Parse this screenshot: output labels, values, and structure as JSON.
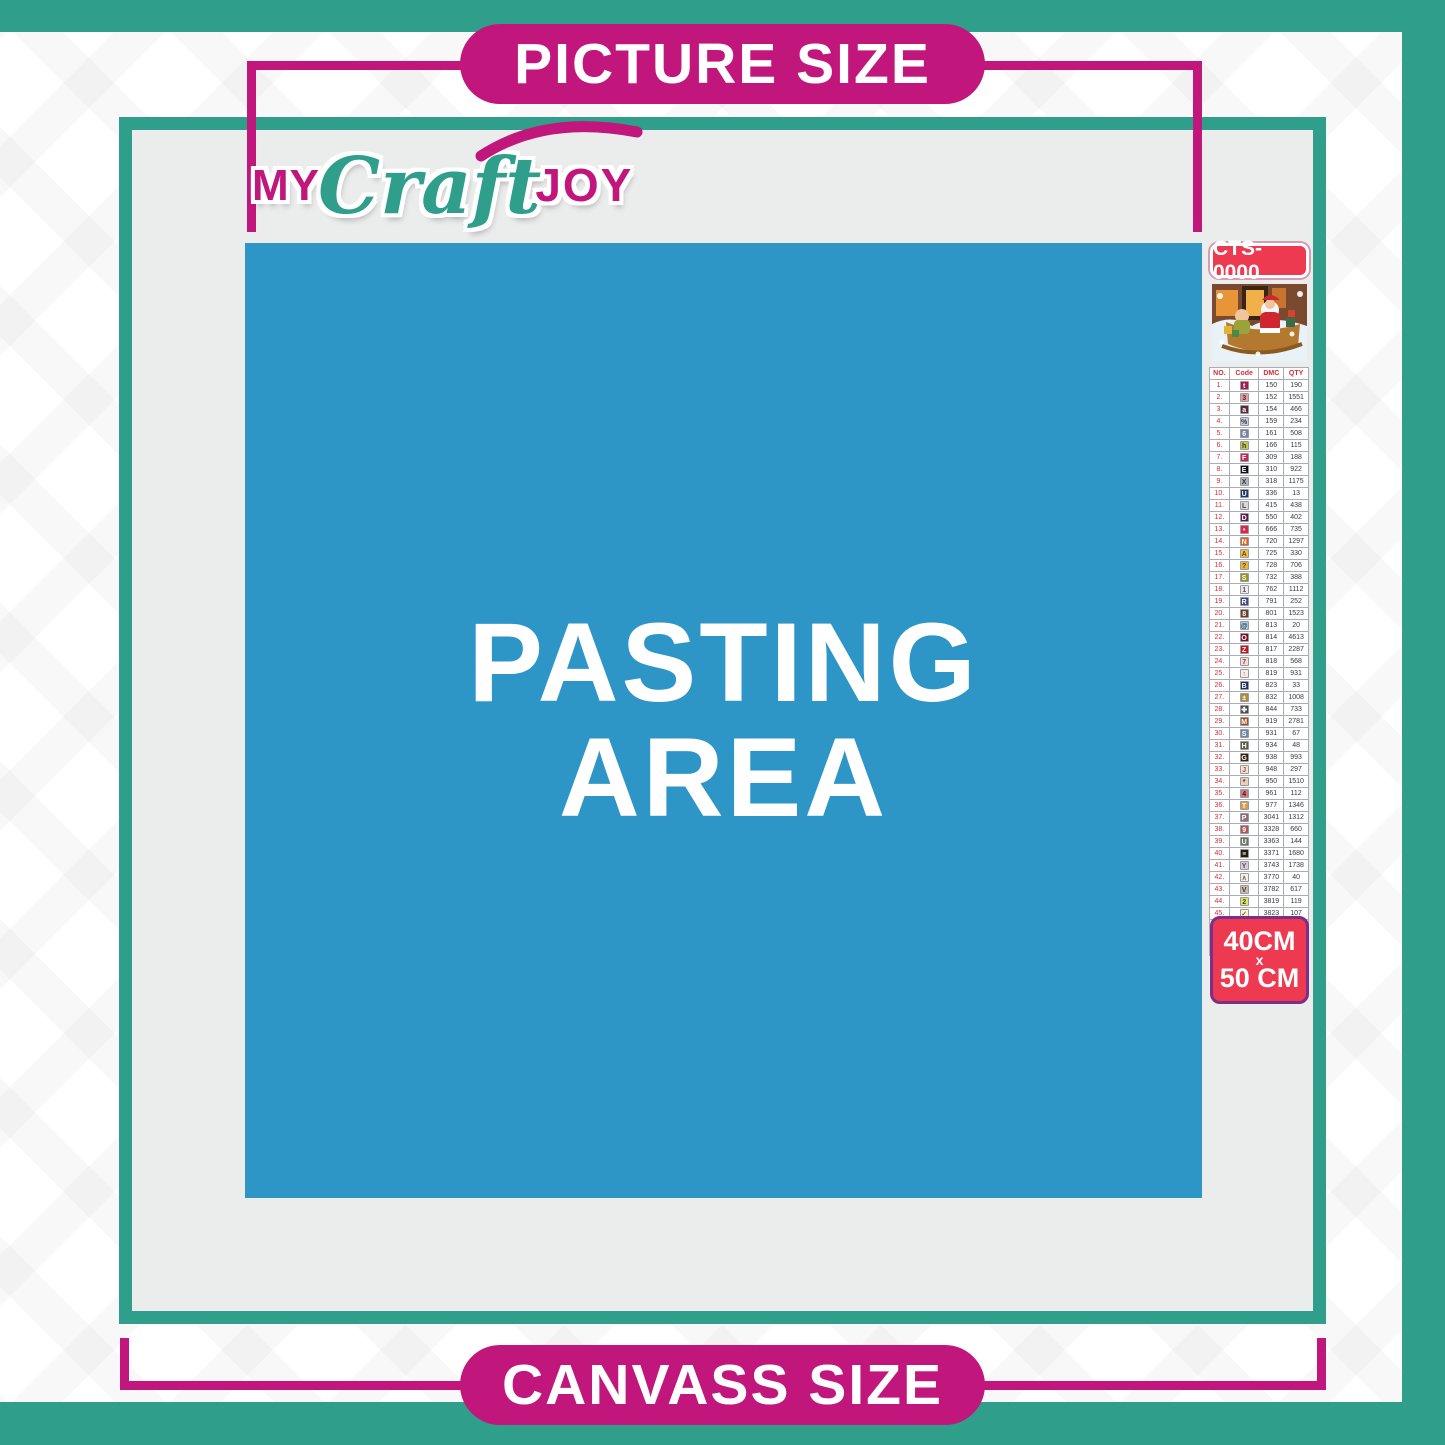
{
  "labels": {
    "picture_size": "PICTURE SIZE",
    "canvass_size": "CANVASS SIZE"
  },
  "logo": {
    "part1": "MY",
    "part2": "Craft",
    "part3": "JOY"
  },
  "pasting_area": {
    "line1": "PASTING",
    "line2": "AREA"
  },
  "legend": {
    "kit_code": "CTS-0000",
    "preview_image": "christmas-santa-sleigh-scene",
    "size": {
      "line1": "40CM",
      "line2": "x",
      "line3": "50 CM"
    },
    "table": {
      "headers": [
        "NO.",
        "Code",
        "DMC",
        "QTY"
      ],
      "rows": [
        {
          "no": "1.",
          "sym": "t",
          "bg": "#a51c4f",
          "fg": "#ffffff",
          "dmc": "150",
          "qty": "190"
        },
        {
          "no": "2.",
          "sym": "3",
          "bg": "#dfa49e",
          "fg": "#5a2430",
          "dmc": "152",
          "qty": "1551"
        },
        {
          "no": "3.",
          "sym": "a",
          "bg": "#5a2a3c",
          "fg": "#ffffff",
          "dmc": "154",
          "qty": "466"
        },
        {
          "no": "4.",
          "sym": "%",
          "bg": "#c9cbd8",
          "fg": "#3a3a52",
          "dmc": "159",
          "qty": "234"
        },
        {
          "no": "5.",
          "sym": "6",
          "bg": "#7a82a6",
          "fg": "#ffffff",
          "dmc": "161",
          "qty": "508"
        },
        {
          "no": "6.",
          "sym": "h",
          "bg": "#c3c553",
          "fg": "#3c3c14",
          "dmc": "166",
          "qty": "115"
        },
        {
          "no": "7.",
          "sym": "F",
          "bg": "#c22a55",
          "fg": "#ffffff",
          "dmc": "309",
          "qty": "188"
        },
        {
          "no": "8.",
          "sym": "E",
          "bg": "#111111",
          "fg": "#ffffff",
          "dmc": "310",
          "qty": "922"
        },
        {
          "no": "9.",
          "sym": "X",
          "bg": "#b0b5bd",
          "fg": "#33333a",
          "dmc": "318",
          "qty": "1175"
        },
        {
          "no": "10.",
          "sym": "U",
          "bg": "#223a6b",
          "fg": "#ffffff",
          "dmc": "336",
          "qty": "13"
        },
        {
          "no": "11.",
          "sym": "L",
          "bg": "#d6d8dc",
          "fg": "#44444a",
          "dmc": "415",
          "qty": "438"
        },
        {
          "no": "12.",
          "sym": "D",
          "bg": "#5e1b51",
          "fg": "#ffffff",
          "dmc": "550",
          "qty": "402"
        },
        {
          "no": "13.",
          "sym": "•",
          "bg": "#e32544",
          "fg": "#ffffff",
          "dmc": "666",
          "qty": "735"
        },
        {
          "no": "14.",
          "sym": "N",
          "bg": "#e2641f",
          "fg": "#ffffff",
          "dmc": "720",
          "qty": "1297"
        },
        {
          "no": "15.",
          "sym": "A",
          "bg": "#f2bf4e",
          "fg": "#6b4a00",
          "dmc": "725",
          "qty": "330"
        },
        {
          "no": "16.",
          "sym": "?",
          "bg": "#e7b53e",
          "fg": "#5d4300",
          "dmc": "728",
          "qty": "706"
        },
        {
          "no": "17.",
          "sym": "S",
          "bg": "#989421",
          "fg": "#ffffff",
          "dmc": "732",
          "qty": "388"
        },
        {
          "no": "18.",
          "sym": "1",
          "bg": "#efe9e9",
          "fg": "#55555a",
          "dmc": "762",
          "qty": "1112"
        },
        {
          "no": "19.",
          "sym": "R",
          "bg": "#3c4b85",
          "fg": "#ffffff",
          "dmc": "791",
          "qty": "252"
        },
        {
          "no": "20.",
          "sym": "8",
          "bg": "#6e4022",
          "fg": "#ffffff",
          "dmc": "801",
          "qty": "1523"
        },
        {
          "no": "21.",
          "sym": "@",
          "bg": "#a9c8de",
          "fg": "#2c4a63",
          "dmc": "813",
          "qty": "20"
        },
        {
          "no": "22.",
          "sym": "O",
          "bg": "#7d1022",
          "fg": "#ffffff",
          "dmc": "814",
          "qty": "4613"
        },
        {
          "no": "23.",
          "sym": "Z",
          "bg": "#c4171d",
          "fg": "#ffffff",
          "dmc": "817",
          "qty": "2287"
        },
        {
          "no": "24.",
          "sym": "7",
          "bg": "#f7dbd6",
          "fg": "#7a4a4a",
          "dmc": "818",
          "qty": "568"
        },
        {
          "no": "25.",
          "sym": "↑",
          "bg": "#f9ebe8",
          "fg": "#77777a",
          "dmc": "819",
          "qty": "931"
        },
        {
          "no": "26.",
          "sym": "B",
          "bg": "#20315f",
          "fg": "#ffffff",
          "dmc": "823",
          "qty": "33"
        },
        {
          "no": "27.",
          "sym": "±",
          "bg": "#ab8d3a",
          "fg": "#ffffff",
          "dmc": "832",
          "qty": "1008"
        },
        {
          "no": "28.",
          "sym": "✤",
          "bg": "#4d4d4d",
          "fg": "#ffffff",
          "dmc": "844",
          "qty": "733"
        },
        {
          "no": "29.",
          "sym": "M",
          "bg": "#a55222",
          "fg": "#ffffff",
          "dmc": "919",
          "qty": "2781"
        },
        {
          "no": "30.",
          "sym": "S",
          "bg": "#6e8aa6",
          "fg": "#ffffff",
          "dmc": "931",
          "qty": "67"
        },
        {
          "no": "31.",
          "sym": "H",
          "bg": "#5a5e3e",
          "fg": "#ffffff",
          "dmc": "934",
          "qty": "48"
        },
        {
          "no": "32.",
          "sym": "G",
          "bg": "#3a2410",
          "fg": "#ffffff",
          "dmc": "938",
          "qty": "993"
        },
        {
          "no": "33.",
          "sym": "J",
          "bg": "#fbe0d1",
          "fg": "#8a5a4a",
          "dmc": "948",
          "qty": "297"
        },
        {
          "no": "34.",
          "sym": "*",
          "bg": "#edcdb6",
          "fg": "#4a3a2a",
          "dmc": "950",
          "qty": "1510"
        },
        {
          "no": "35.",
          "sym": "4",
          "bg": "#d17a82",
          "fg": "#4d1a1f",
          "dmc": "961",
          "qty": "112"
        },
        {
          "no": "36.",
          "sym": "T",
          "bg": "#db9c52",
          "fg": "#ffffff",
          "dmc": "977",
          "qty": "1346"
        },
        {
          "no": "37.",
          "sym": "P",
          "bg": "#8f6c78",
          "fg": "#ffffff",
          "dmc": "3041",
          "qty": "1312"
        },
        {
          "no": "38.",
          "sym": "9",
          "bg": "#b65551",
          "fg": "#ffffff",
          "dmc": "3328",
          "qty": "660"
        },
        {
          "no": "39.",
          "sym": "U",
          "bg": "#6a7b5c",
          "fg": "#ffffff",
          "dmc": "3363",
          "qty": "144"
        },
        {
          "no": "40.",
          "sym": "≡",
          "bg": "#281c0e",
          "fg": "#ffffff",
          "dmc": "3371",
          "qty": "1680"
        },
        {
          "no": "41.",
          "sym": "Y",
          "bg": "#d9cdd5",
          "fg": "#5a4a5a",
          "dmc": "3743",
          "qty": "1738"
        },
        {
          "no": "42.",
          "sym": "∧",
          "bg": "#f9eee4",
          "fg": "#7a6a5a",
          "dmc": "3770",
          "qty": "40"
        },
        {
          "no": "43.",
          "sym": "V",
          "bg": "#ccbca9",
          "fg": "#4a3a2a",
          "dmc": "3782",
          "qty": "617"
        },
        {
          "no": "44.",
          "sym": "2",
          "bg": "#dfe46c",
          "fg": "#4a4a00",
          "dmc": "3819",
          "qty": "119"
        },
        {
          "no": "45.",
          "sym": "✓",
          "bg": "#fdf5d1",
          "fg": "#6a6a2a",
          "dmc": "3823",
          "qty": "107"
        },
        {
          "no": "46.",
          "sym": "C",
          "bg": "#ef913f",
          "fg": "#ffffff",
          "dmc": "3853",
          "qty": "1332"
        },
        {
          "no": "47.",
          "sym": "K",
          "bg": "#8c4738",
          "fg": "#ffffff",
          "dmc": "3858",
          "qty": "2311"
        },
        {
          "no": "48.",
          "sym": "A",
          "bg": "#9e8265",
          "fg": "#ffffff",
          "dmc": "3863",
          "qty": "1820"
        }
      ]
    }
  },
  "colors": {
    "teal": "#2f9e8b",
    "magenta": "#c1167b",
    "blue": "#2e95c7",
    "canvas_gray": "#ebecec",
    "crimson": "#ee3a50",
    "badge_border_purple": "#7b2e8a",
    "table_red": "#d62c3a"
  }
}
